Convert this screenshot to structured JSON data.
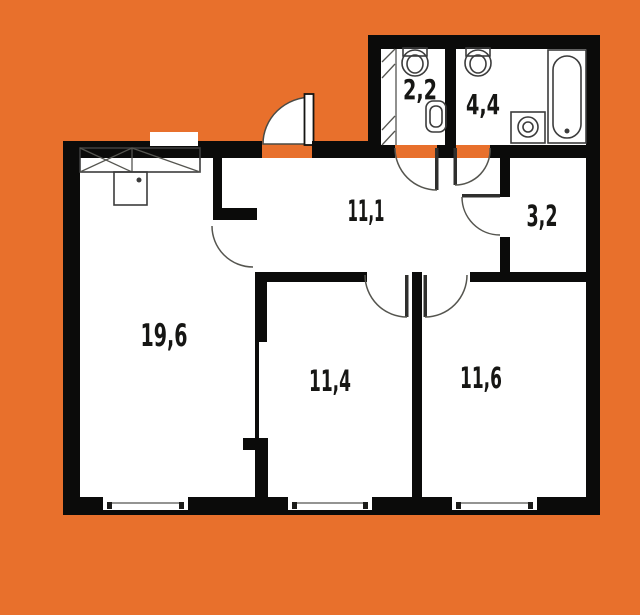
{
  "title": "Two-bedroom apartment floor plan",
  "colors": {
    "background": "#E8702C",
    "wall": "#0B0B0A",
    "floor": "#FFFFFF",
    "fixture_line": "#3C3C3C",
    "label_text": "#161614"
  },
  "plan": {
    "type": "apartment-floor-plan",
    "rooms": [
      {
        "name": "living-room-kitchen",
        "area": "19,6"
      },
      {
        "name": "hallway",
        "area": "11,1"
      },
      {
        "name": "bedroom-1",
        "area": "11,4"
      },
      {
        "name": "bedroom-2",
        "area": "11,6"
      },
      {
        "name": "wc",
        "area": "2,2"
      },
      {
        "name": "bathroom",
        "area": "4,4"
      },
      {
        "name": "storage",
        "area": "3,2"
      }
    ],
    "fixtures": [
      "bathtub",
      "washing-machine",
      "washbasin-bathroom",
      "washbasin-wc",
      "toilet",
      "ventilation-shaft",
      "kitchen-counter",
      "kitchen-appliance"
    ],
    "windows_count": 3,
    "doors_count": 7
  }
}
